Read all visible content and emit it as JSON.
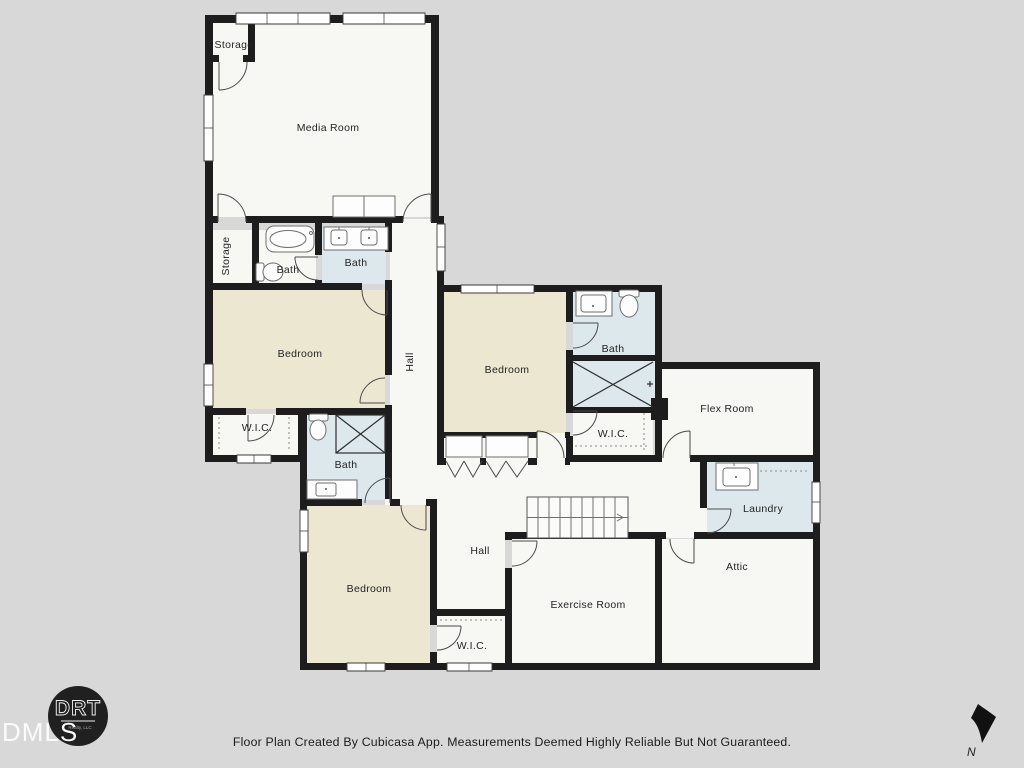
{
  "plan": {
    "colors": {
      "background": "#d8d8d8",
      "wall": "#1d1d1e",
      "floor": "#f7f7f4",
      "bedroom": "#ebe7d1",
      "bath": "#dce8ec"
    },
    "rooms": {
      "storage_top": {
        "label": "Storage"
      },
      "media": {
        "label": "Media Room"
      },
      "storage_left": {
        "label": "Storage"
      },
      "bath_upper_left": {
        "label": "Bath"
      },
      "bath_upper_mid": {
        "label": "Bath"
      },
      "hall_upper": {
        "label": "Hall"
      },
      "bedroom_left": {
        "label": "Bedroom"
      },
      "wic_left": {
        "label": "W.I.C."
      },
      "bath_mid_left": {
        "label": "Bath"
      },
      "bedroom_center": {
        "label": "Bedroom"
      },
      "bath_right": {
        "label": "Bath"
      },
      "wic_center": {
        "label": "W.I.C."
      },
      "flex": {
        "label": "Flex Room"
      },
      "laundry": {
        "label": "Laundry"
      },
      "hall_lower": {
        "label": "Hall"
      },
      "bedroom_lower": {
        "label": "Bedroom"
      },
      "wic_lower": {
        "label": "W.I.C."
      },
      "exercise": {
        "label": "Exercise Room"
      },
      "attic": {
        "label": "Attic"
      }
    }
  },
  "footer": {
    "disclaimer": "Floor Plan Created By Cubicasa App. Measurements Deemed Highly Reliable But Not Guaranteed."
  },
  "logo": {
    "mls": "DMLS",
    "brand": "DRT",
    "brand_sub": "Realty, LLC"
  },
  "compass": {
    "label": "N"
  }
}
